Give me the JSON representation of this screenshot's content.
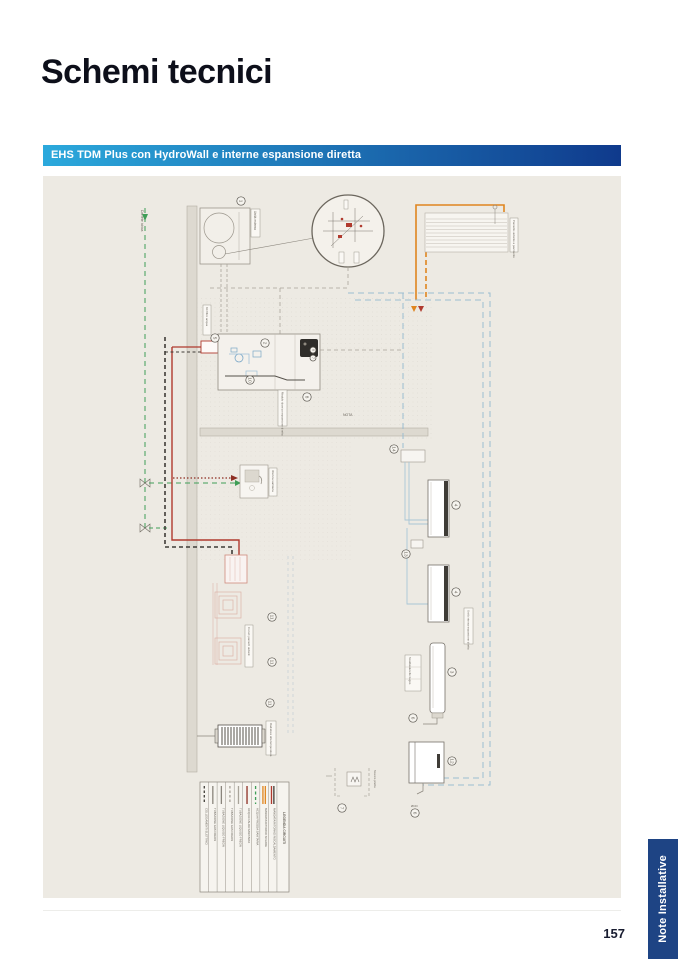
{
  "page": {
    "title": "Schemi tecnici",
    "page_number": "157",
    "side_tab": "Note Installative",
    "tab_color": "#1E4484"
  },
  "banner": {
    "label": "EHS TDM Plus con HydroWall e interne espansione diretta",
    "gradient_from": "#2BA9DC",
    "gradient_to": "#0F3A8C",
    "text_color": "#FFFFFF"
  },
  "diagram": {
    "background": "#EDEAE3",
    "labels": {
      "water_supply": "Da rete idrica",
      "outdoor_unit": "Unità esterna",
      "filter_kit": "Kit filtro acqua",
      "module": "Modulo idronico espansione diretta",
      "radiant_panel": "Pannello radiante a pavimento",
      "radiant_circuits": "Circuiti pannelli radianti",
      "fan_coil": "Unità interna espansione diretta",
      "towel_warmer": "Scaldasalviette bagno",
      "radiator": "Radiatore alta temperatura",
      "sink": "Utenza sanitaria",
      "drain": "Scarico piletta",
      "note": "NOTA",
      "duct_note": "ØCD"
    },
    "callouts": [
      {
        "n": "1",
        "x": 198,
        "y": 25
      },
      {
        "n": "5",
        "x": 172,
        "y": 162
      },
      {
        "n": "2",
        "x": 222,
        "y": 167
      },
      {
        "n": "9",
        "x": 270,
        "y": 174,
        "s": 3
      },
      {
        "n": "7",
        "x": 270,
        "y": 182,
        "s": 3
      },
      {
        "n": "10",
        "x": 207,
        "y": 204
      },
      {
        "n": "8",
        "x": 264,
        "y": 221
      },
      {
        "n": "14",
        "x": 351,
        "y": 273
      },
      {
        "n": "13",
        "x": 363,
        "y": 378
      },
      {
        "n": "4",
        "x": 413,
        "y": 329
      },
      {
        "n": "4",
        "x": 413,
        "y": 416
      },
      {
        "n": "3",
        "x": 409,
        "y": 496
      },
      {
        "n": "6",
        "x": 370,
        "y": 542
      },
      {
        "n": "12",
        "x": 409,
        "y": 585
      },
      {
        "n": "6",
        "x": 372,
        "y": 637
      },
      {
        "n": "7",
        "x": 299,
        "y": 632
      },
      {
        "n": "11",
        "x": 229,
        "y": 441
      },
      {
        "n": "11",
        "x": 229,
        "y": 486
      },
      {
        "n": "11",
        "x": 227,
        "y": 527
      }
    ],
    "legend": {
      "title": "LEGENDA CIRCUITI",
      "rows": [
        {
          "label": "COLLEGAMENTI ELETTRICI",
          "colors": [
            "#3F3C37"
          ],
          "dash": "2.5,2"
        },
        {
          "label": "TUBAZIONE GAS FREON",
          "colors": [
            "#8A857C"
          ],
          "dash": ""
        },
        {
          "label": "TUBAZIONE LIQUIDO FREON",
          "colors": [
            "#8A857C"
          ],
          "dash": ""
        },
        {
          "label": "TUBAZIONE GAS FREON",
          "colors": [
            "#A8A399"
          ],
          "dash": "2.5,2"
        },
        {
          "label": "TUBAZIONE LIQUIDO FREON",
          "colors": [
            "#A8A399"
          ],
          "dash": ""
        },
        {
          "label": "ACQUA CALDA SANITARIA",
          "colors": [
            "#8E2F23"
          ],
          "dash": ""
        },
        {
          "label": "ACQUA FREDDA SANITARIA",
          "colors": [
            "#3F9E57"
          ],
          "dash": "3,2.5"
        },
        {
          "label": "MANDATA/RITORNO SOLARE",
          "colors": [
            "#E0851F",
            "#E0851F"
          ],
          "dash": ""
        },
        {
          "label": "MANDATA/RITORNO RISCALDAMENTO",
          "colors": [
            "#B03A2E",
            "#3F3C37"
          ],
          "dash": ""
        }
      ]
    },
    "colors": {
      "pipe_hot": "#B03A2E",
      "pipe_hot_dark": "#8E2F23",
      "pipe_cold": "#3F9E57",
      "pipe_solar": "#E0851F",
      "pipe_refrigerant": "#A8A399",
      "pipe_fancoil": "#9BBDD1",
      "electrical": "#3F3C37",
      "wall": "#DDD9D0",
      "line": "#8A857C"
    }
  }
}
